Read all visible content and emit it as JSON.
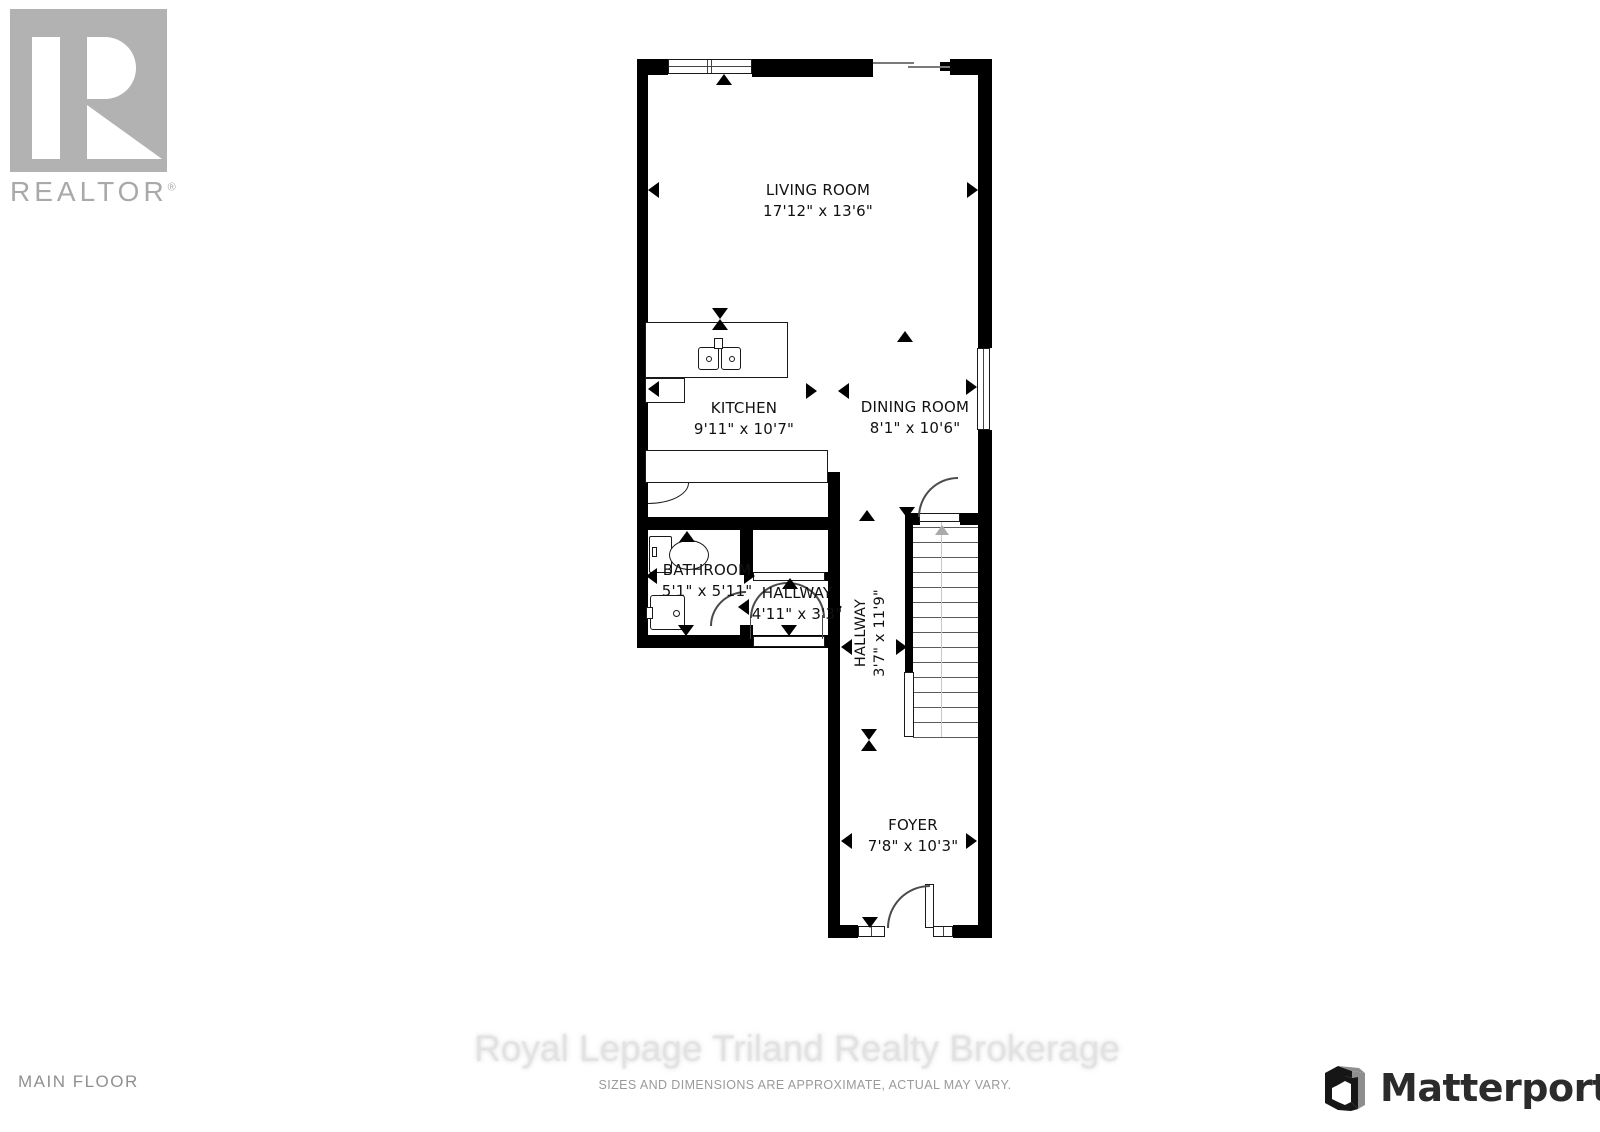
{
  "branding": {
    "realtor": {
      "label": "REALTOR",
      "reg": "®"
    },
    "matterport": {
      "label": "Matterport"
    }
  },
  "plan": {
    "floor_label": "MAIN FLOOR",
    "rooms": [
      {
        "name": "LIVING ROOM",
        "dims": "17'12\" x 13'6\""
      },
      {
        "name": "KITCHEN",
        "dims": "9'11\" x 10'7\""
      },
      {
        "name": "DINING ROOM",
        "dims": "8'1\" x 10'6\""
      },
      {
        "name": "BATHROOM",
        "dims": "5'1\" x 5'11\""
      },
      {
        "name": "HALLWAY",
        "dims": "4'11\" x 3'3\""
      },
      {
        "name": "HALLWAY",
        "dims": "3'7\" x 11'9\""
      },
      {
        "name": "FOYER",
        "dims": "7'8\" x 10'3\""
      }
    ]
  },
  "footer": {
    "watermark": "Royal Lepage Triland Realty Brokerage",
    "disclaimer": "SIZES AND DIMENSIONS ARE APPROXIMATE, ACTUAL MAY VARY."
  },
  "colors": {
    "wall": "#000000",
    "label_text": "#111111",
    "logo_gray": "#b0b0b0",
    "watermark_gray": "#e2e2e2",
    "matterport_dark": "#2b2b2b"
  }
}
